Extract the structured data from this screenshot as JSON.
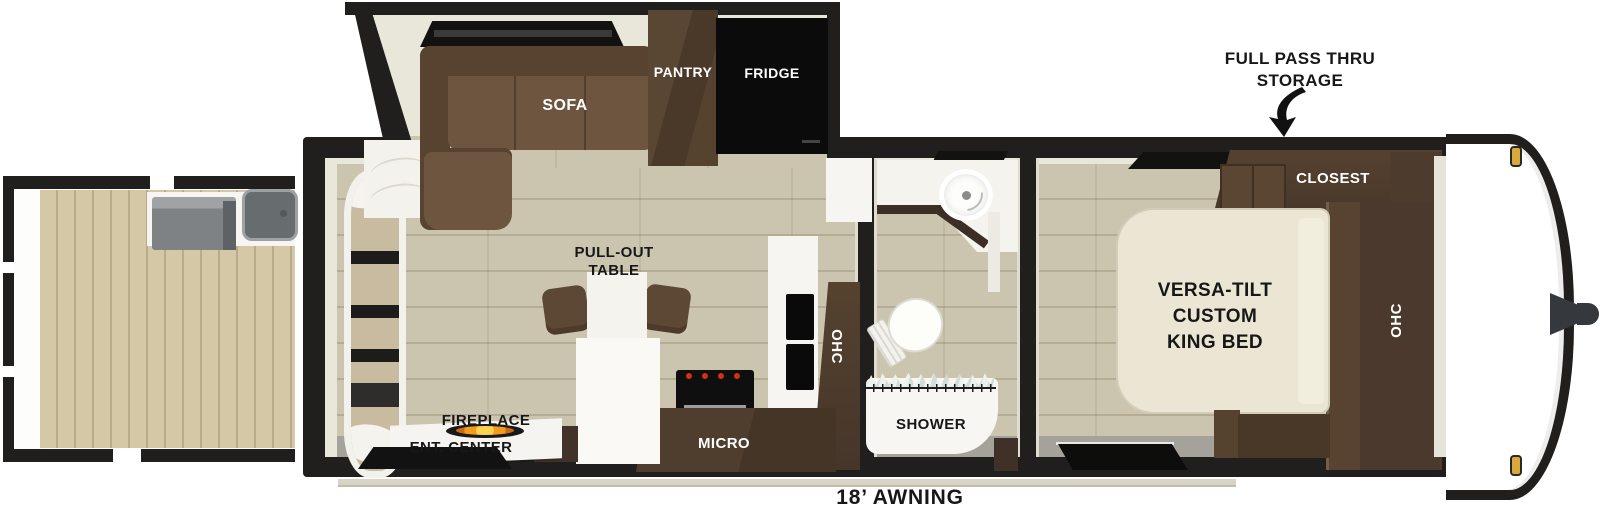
{
  "floorplan": {
    "annotations": {
      "storage_line1": "FULL PASS THRU",
      "storage_line2": "STORAGE",
      "awning_label": "18’ AWNING"
    },
    "living_room": {
      "sofa_label": "SOFA",
      "pantry_label": "PANTRY",
      "fridge_label": "FRIDGE",
      "table_label_line1": "PULL-OUT",
      "table_label_line2": "TABLE",
      "fireplace_label": "FIREPLACE",
      "ent_center_label": "ENT. CENTER",
      "micro_label": "MICRO",
      "ohc_label": "OHC"
    },
    "bathroom": {
      "shower_label": "SHOWER"
    },
    "bedroom": {
      "closet_label": "CLOSEST",
      "bed_label_line1": "VERSA-TILT",
      "bed_label_line2": "CUSTOM",
      "bed_label_line3": "KING BED",
      "ohc_label": "OHC"
    },
    "colors": {
      "wall-black": "#201f1d",
      "interior-cream": "#e9e6da",
      "floor-tan": "#cbc4ae",
      "deck-tan": "#d5c8a7",
      "cabinet-brown": "#4e3b2d",
      "sofa-brown": "#6e553f",
      "sofa-dark": "#57432f",
      "bed-cream": "#eae6d3",
      "counter-white": "#f6f5f1",
      "floor-gray": "#a5a29b",
      "window-black": "#121211",
      "flame-orange": "#f49b1e",
      "marker-amber": "#dba83c",
      "hitch-gray": "#35383c"
    }
  }
}
